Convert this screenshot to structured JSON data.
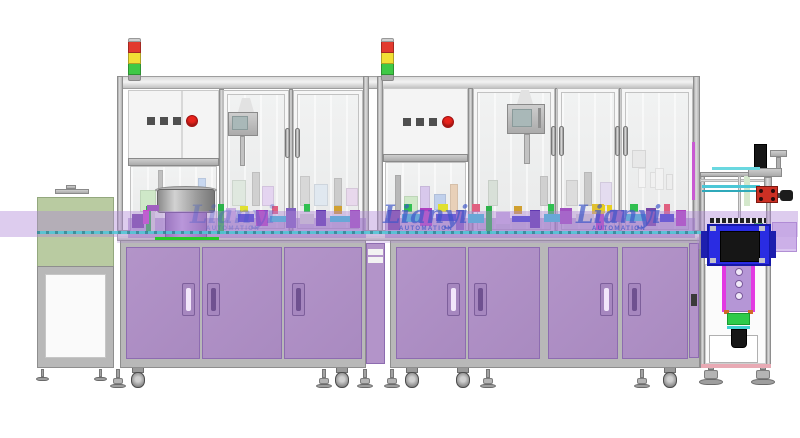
{
  "scene": {
    "description": "Industrial automation assembly line CAD render, front elevation",
    "background": "#ffffff"
  },
  "watermarks": [
    {
      "brand": "Lianyi",
      "subtitle": "AUTOMATION"
    },
    {
      "brand": "Lianyi",
      "subtitle": "AUTOMATION"
    },
    {
      "brand": "Lianyi",
      "subtitle": "AUTOMATION"
    }
  ],
  "stack_light": {
    "segment_colors": [
      "#e23a2e",
      "#f2df35",
      "#3fc946"
    ],
    "cap_color": "#cfcfcf",
    "base_color": "#a8a8a8"
  },
  "control_panel": {
    "square_button_count": 3,
    "square_button_color": "#4f4f4f",
    "round_button_color": "#e8231c"
  },
  "palette": {
    "cabinet_purple": "#b394c9",
    "cabinet_purple_dark": "#a185ba",
    "handle_slot_light": "#f2e6fa",
    "handle_slot_dark": "#6f5190",
    "frame_gray": "#b9b9b9",
    "overlay_purple": "rgba(175,133,214,0.42)",
    "green_box": "rgba(175,196,148,0.88)",
    "accent_green_line": "#27cc27",
    "conveyor_cyan": "#4cc7d6",
    "blue_box": "#2a2ce2",
    "watermark_blue": "#3c55c8"
  }
}
